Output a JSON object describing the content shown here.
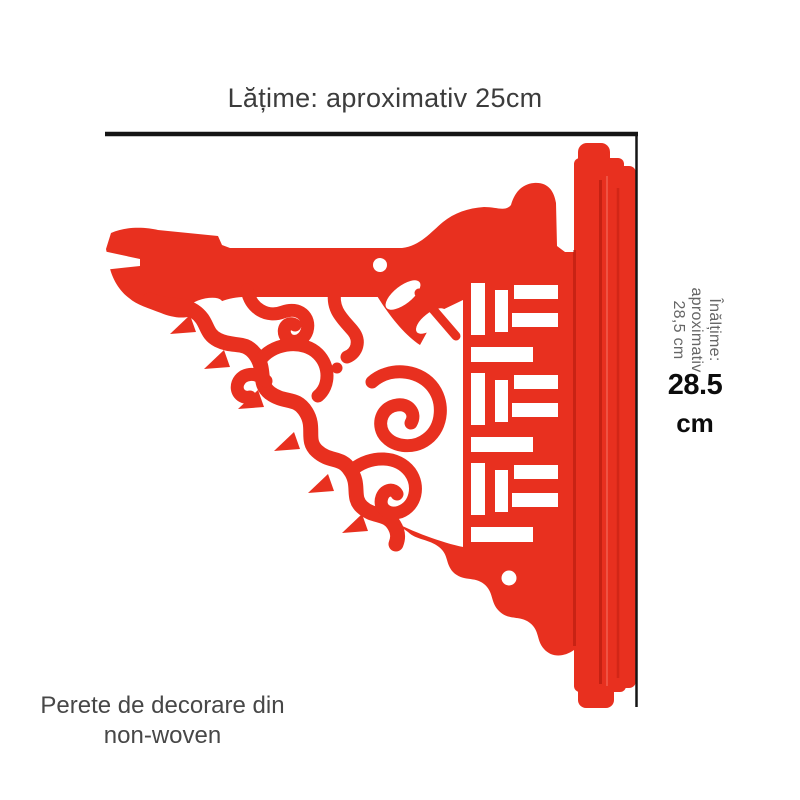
{
  "annotations": {
    "width_label": "Lățime: aproximativ 25cm",
    "height_rotated": {
      "line1": "Înălțime:",
      "line2": "aproximativ",
      "line3": "28,5 cm"
    },
    "height_value": "28.5",
    "height_unit": "cm"
  },
  "caption": {
    "line1": "Perete de decorare din",
    "line2": "non-woven"
  },
  "product": {
    "illustration": "red-felt-wall-bracket-with-scroll-and-lattice-cutouts",
    "width_dimension": "25 cm",
    "height_dimension": "28.5 cm"
  },
  "colors": {
    "felt_red": "#e8301f",
    "felt_dark": "#a8150a",
    "felt_deep": "#8f1004",
    "felt_light": "#f4695b",
    "line": "#151515",
    "text_dark": "#3c3c3c",
    "text_gray": "#666666",
    "text_black": "#0c0c0c",
    "text_caption": "#474747"
  }
}
